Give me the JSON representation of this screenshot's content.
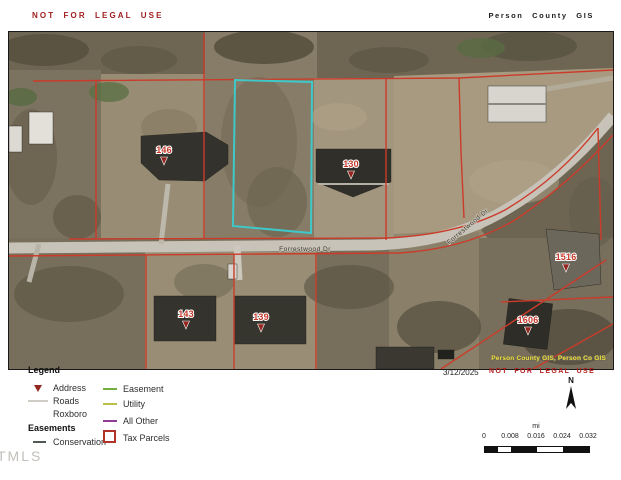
{
  "header": {
    "disclaimer": "NOT FOR LEGAL USE",
    "title": "Person County GIS"
  },
  "map": {
    "street_label": "Forrestwood Dr",
    "street_label_curve": "Forrestwood Dr",
    "attribution": "Person County GIS, Person Co GIS",
    "highlight_color": "#3fc8c9",
    "parcel_line_color": "#cc3b2a",
    "markers": [
      {
        "label": "146"
      },
      {
        "label": "130"
      },
      {
        "label": "143"
      },
      {
        "label": "139"
      },
      {
        "label": "1516"
      },
      {
        "label": "1606"
      }
    ]
  },
  "legend": {
    "title": "Legend",
    "group2_title": "Easements",
    "col1": [
      {
        "label": "Address"
      },
      {
        "label": "Roads"
      },
      {
        "label": "Roxboro"
      },
      {
        "label": "Conservation"
      }
    ],
    "col2": [
      {
        "label": "Easement"
      },
      {
        "label": "Utility"
      },
      {
        "label": "All Other"
      },
      {
        "label": "Tax Parcels"
      }
    ],
    "colors": {
      "address": "#93261f",
      "roads": "#d0cdc7",
      "conservation": "#4e5a52",
      "easement": "#74ae40",
      "utility": "#bcbe4a",
      "all_other": "#8e3c97",
      "tax_parcels": "#b03427"
    }
  },
  "footer": {
    "date": "3/12/2025",
    "disclaimer": "NOT FOR LEGAL USE",
    "watermark": "TMLS"
  },
  "north_arrow": {
    "label": "N"
  },
  "scale_bar": {
    "unit": "mi",
    "ticks": [
      "0",
      "0.008",
      "0.016",
      "0.024",
      "0.032"
    ]
  }
}
